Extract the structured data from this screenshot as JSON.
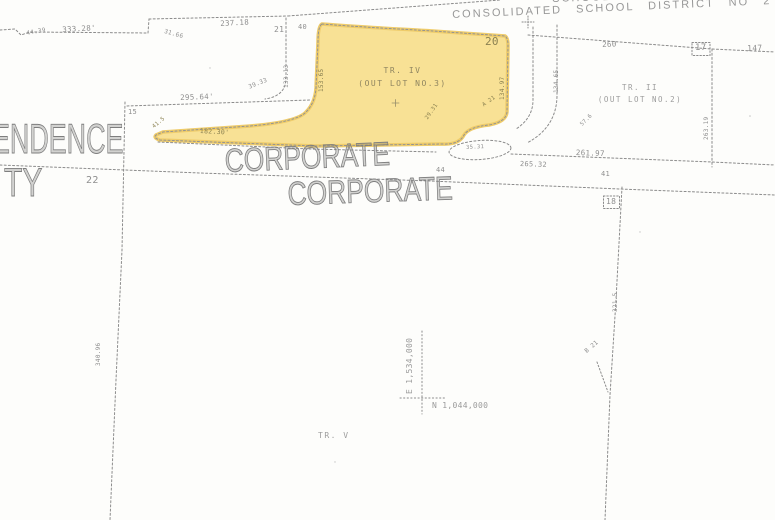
{
  "map": {
    "title_partial_top": "SCHOOL DISTRICT",
    "district_title": "CONSOLIDATED SCHOOL DISTRICT NO 2",
    "large_labels": {
      "endence": "ENDENCE",
      "ty": "TY",
      "corporate_upper": "CORPORATE",
      "corporate_lower": "CORPORATE"
    },
    "parcels": {
      "tract_iv": {
        "name": "TR. IV",
        "sub": "(OUT LOT NO.3)",
        "highlight_color": "#f7dd86"
      },
      "tract_ii": {
        "name": "TR. II",
        "sub": "(OUT LOT NO.2)"
      },
      "tract_v": {
        "name": "TR. V"
      }
    },
    "coordinates": {
      "north": "N 1,044,000",
      "east": "E 1,534,000"
    },
    "dimensions": {
      "d4439": "44.39",
      "d33328": "333.28'",
      "d3166": "31.66",
      "d23718": "237.18",
      "n21": "21",
      "n40": "40",
      "n20": "20",
      "n22": "22",
      "n15": "15",
      "n17": "17",
      "n18": "18",
      "n41": "41",
      "n44": "44",
      "n147": "147",
      "n260": "260",
      "d29564": "295.64'",
      "d3933": "39.33",
      "d18230": "182.30'",
      "d415": "41.5",
      "d2931": "29.31",
      "a21": "A 21",
      "b21": "B 21",
      "d3531": "35.31",
      "d576": "57.6",
      "d26532": "265.32",
      "d26197": "261.97",
      "d15365": "153.65",
      "d13313": "133.13",
      "d13497": "134.97",
      "d13465": "134.65",
      "d26319": "263.19",
      "d3215": "321.5",
      "d34096": "340.96"
    },
    "colors": {
      "highlight": "#f7dd86",
      "ink": "#8a8a8a"
    }
  }
}
